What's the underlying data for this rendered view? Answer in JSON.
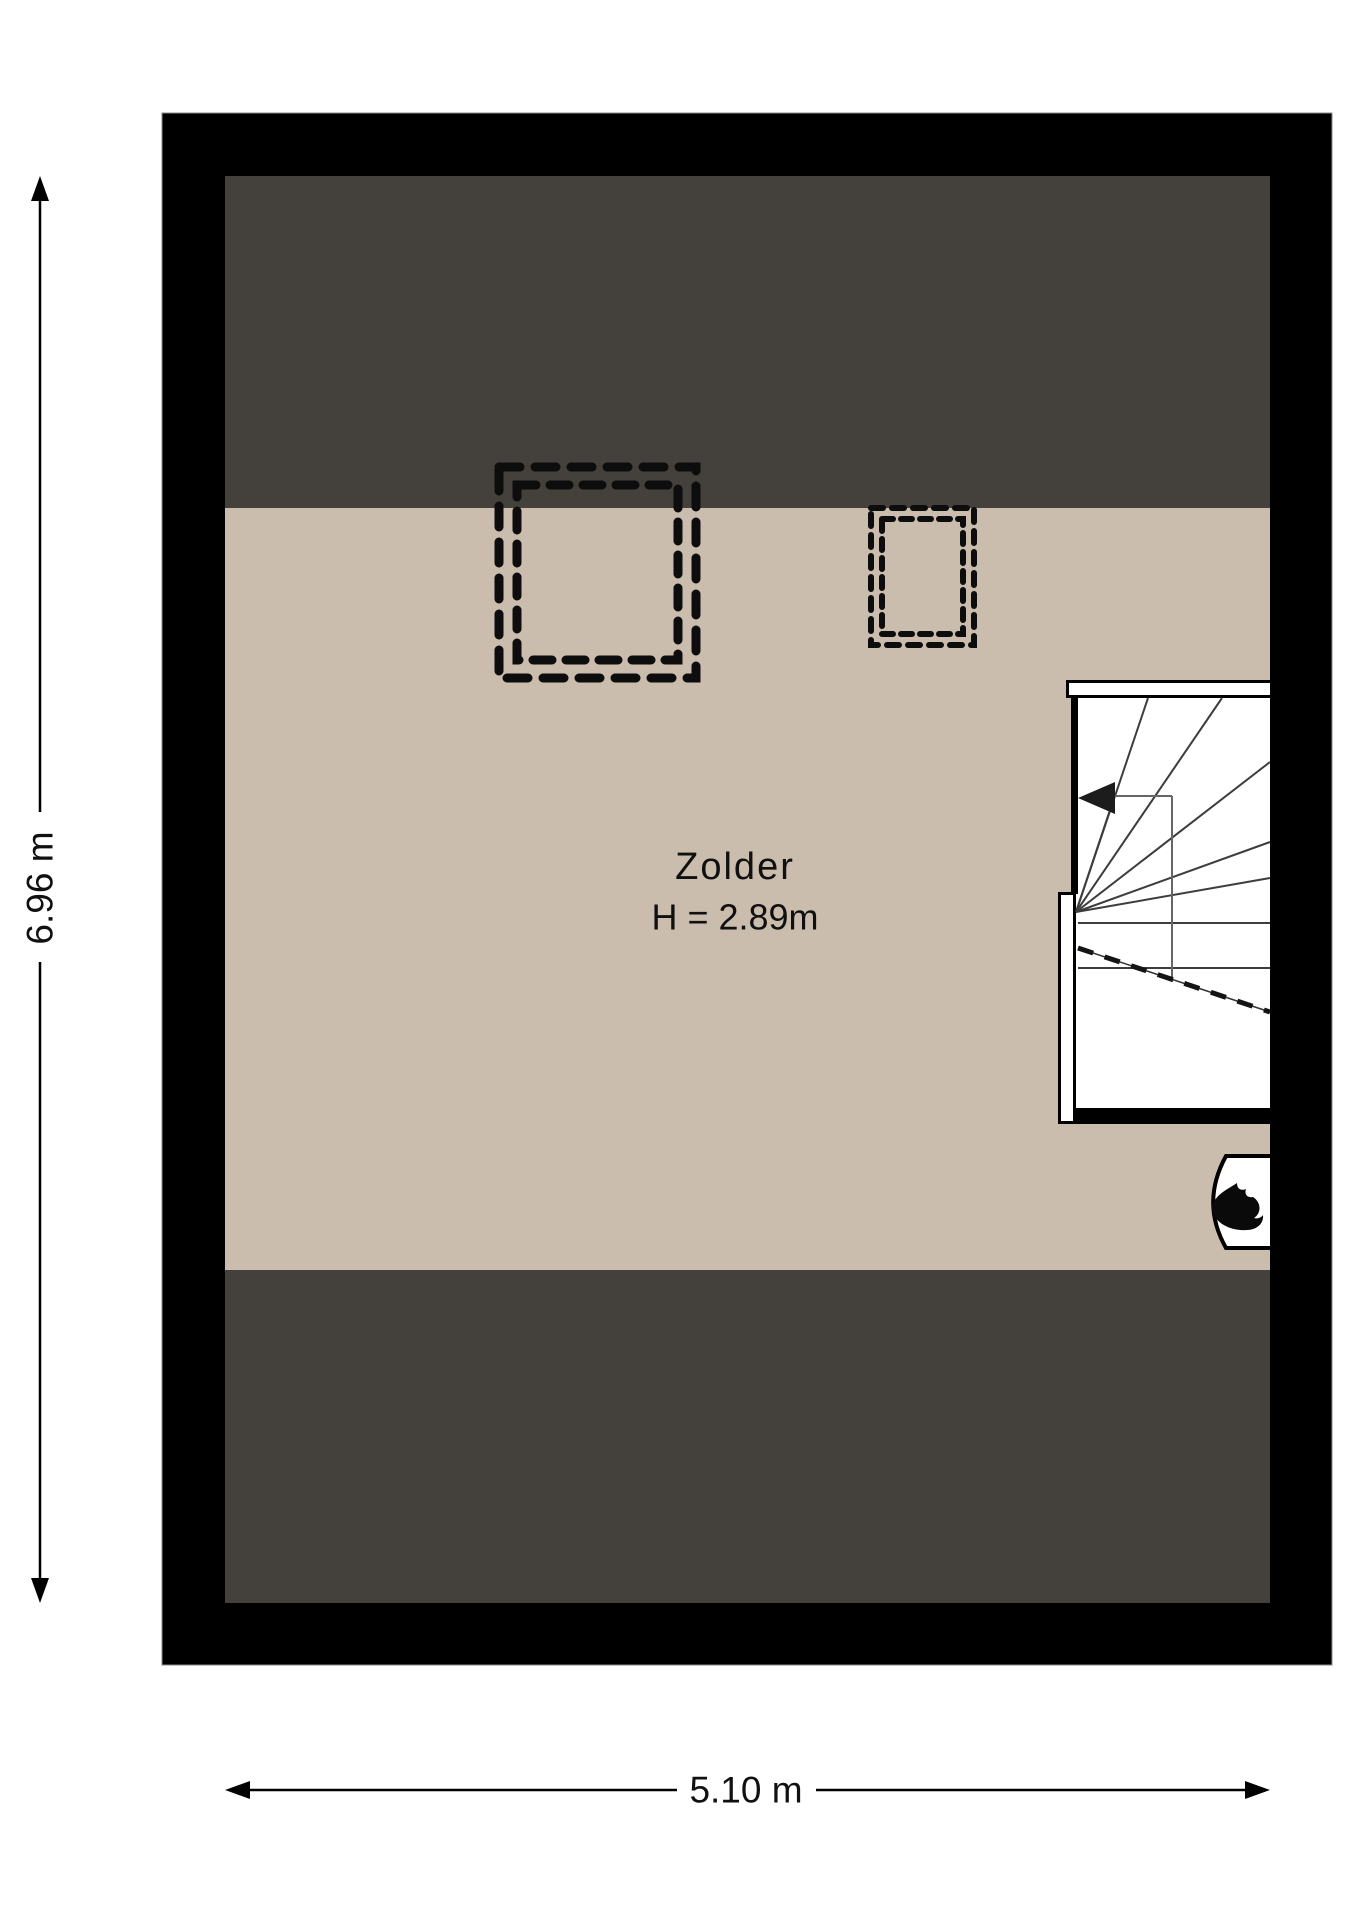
{
  "page": {
    "background": "#ffffff"
  },
  "plan": {
    "room": {
      "label": "Zolder",
      "height": "H = 2.89m"
    },
    "dimensions": {
      "height_label": "6.96 m",
      "width_label": "5.10 m"
    },
    "colors": {
      "wall": "#000000",
      "roof_slope": "#44403c",
      "floor": "#cabdad",
      "stairwell": "#ffffff",
      "lines": "#0d0d0d"
    },
    "features": {
      "skylights": [
        {
          "name": "skylight-large"
        },
        {
          "name": "skylight-small"
        }
      ],
      "stairs": {
        "name": "staircase"
      },
      "boiler": {
        "icon": "flame-icon"
      }
    }
  }
}
